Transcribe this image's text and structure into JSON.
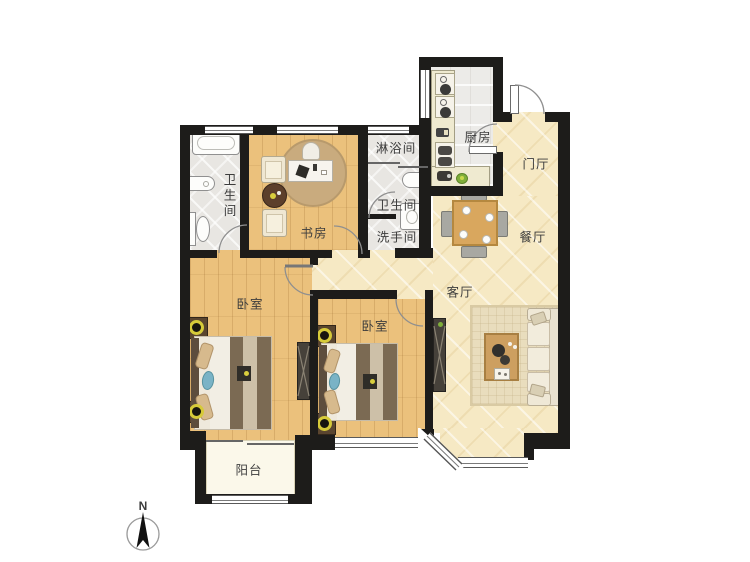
{
  "rooms": {
    "master_bathroom": "卫生间",
    "study": "书房",
    "shower_room": "淋浴间",
    "toilet": "卫生间",
    "washroom": "洗手间",
    "kitchen": "厨房",
    "foyer": "门厅",
    "dining_room": "餐厅",
    "living_room": "客厅",
    "bedroom_left": "卧室",
    "bedroom_right": "卧室",
    "balcony": "阳台"
  },
  "compass": {
    "north": "N"
  },
  "colors": {
    "wall": "#1d1c1a",
    "wood_floor": "#ebc17c",
    "tile_floor": "#f6e9c4",
    "wet_floor": "#e8e6e2",
    "balcony_floor": "#fbf8ea",
    "lamp_accent": "#d6ca39"
  }
}
